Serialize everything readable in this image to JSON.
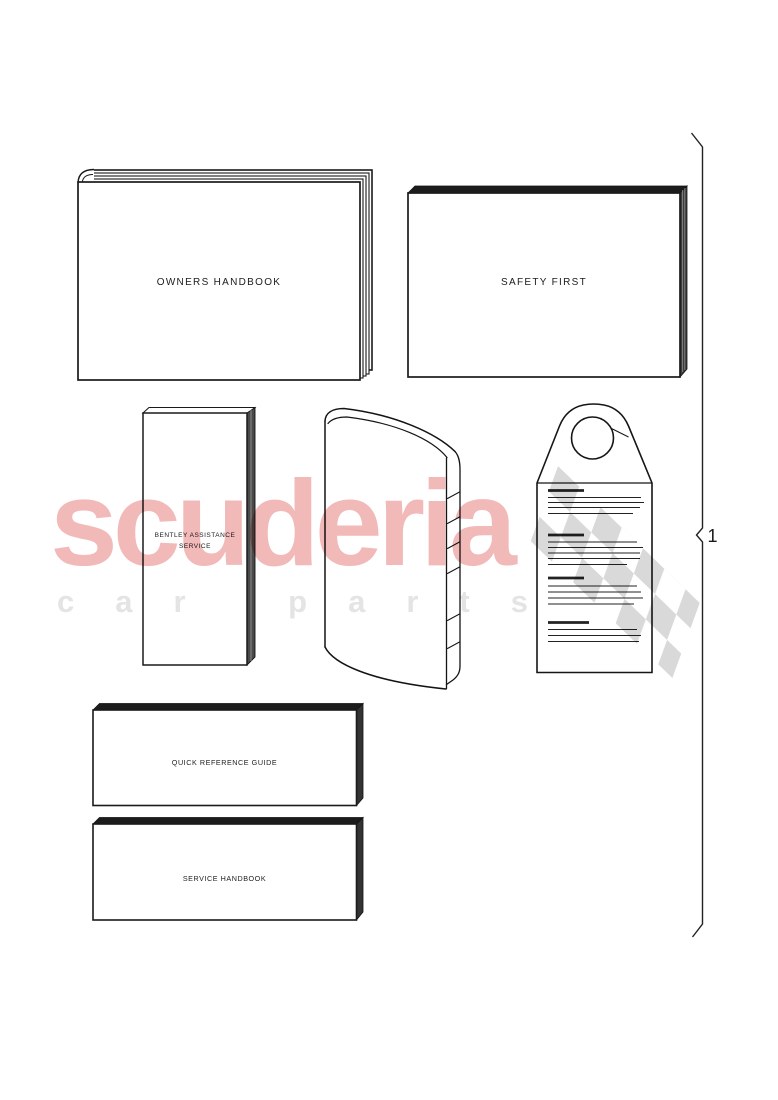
{
  "diagram": {
    "callout_number": "1",
    "parts": [
      {
        "name": "owners-handbook",
        "label": "OWNERS HANDBOOK"
      },
      {
        "name": "safety-first",
        "label": "SAFETY FIRST"
      },
      {
        "name": "bentley-assistance-service",
        "label_lines": [
          "BENTLEY ASSISTANCE",
          "SERVICE"
        ]
      },
      {
        "name": "document-wallet"
      },
      {
        "name": "hang-tag"
      },
      {
        "name": "quick-reference-guide",
        "label": "QUICK REFERENCE GUIDE"
      },
      {
        "name": "service-handbook",
        "label": "SERVICE HANDBOOK"
      }
    ]
  },
  "watermark": {
    "brand": "scuderia",
    "subtitle": "car parts",
    "brand_color": "#f2b9b9",
    "subtitle_color": "#e4e4e4",
    "flag_color": "#d9d9d9"
  }
}
